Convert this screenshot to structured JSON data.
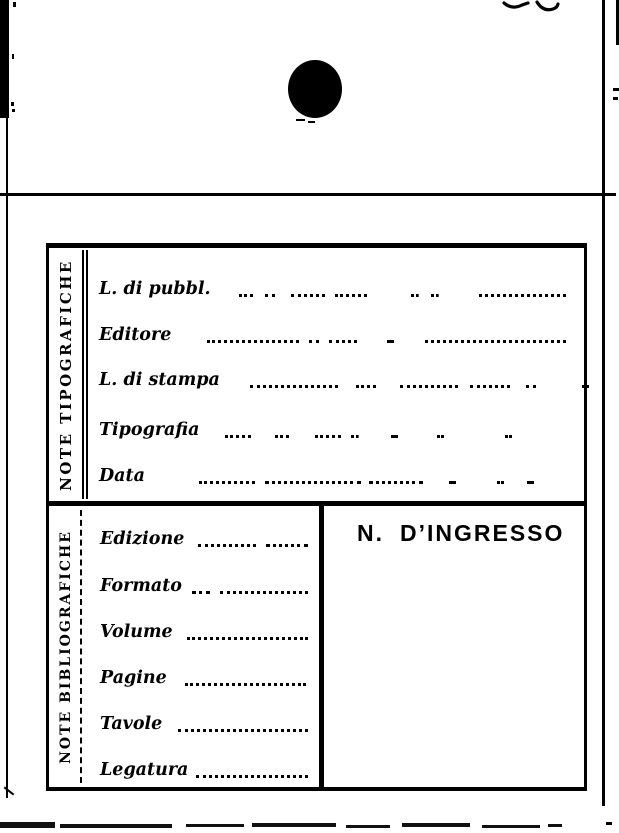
{
  "card": {
    "tip": {
      "section_label": "NOTE TIPOGRAFICHE",
      "fields": [
        {
          "label": "L. di pubbl."
        },
        {
          "label": "Editore"
        },
        {
          "label": "L. di stampa"
        },
        {
          "label": "Tipografia"
        },
        {
          "label": "Data"
        }
      ]
    },
    "bib": {
      "section_label": "NOTE BIBLIOGRAFICHE",
      "fields": [
        {
          "label": "Edizione"
        },
        {
          "label": "Formato"
        },
        {
          "label": "Volume"
        },
        {
          "label": "Pagine"
        },
        {
          "label": "Tavole"
        },
        {
          "label": "Legatura"
        }
      ],
      "ingresso": {
        "prefix": "N.",
        "label": "D’INGRESSO"
      }
    }
  },
  "colors": {
    "ink": "#000000",
    "paper": "#ffffff"
  }
}
